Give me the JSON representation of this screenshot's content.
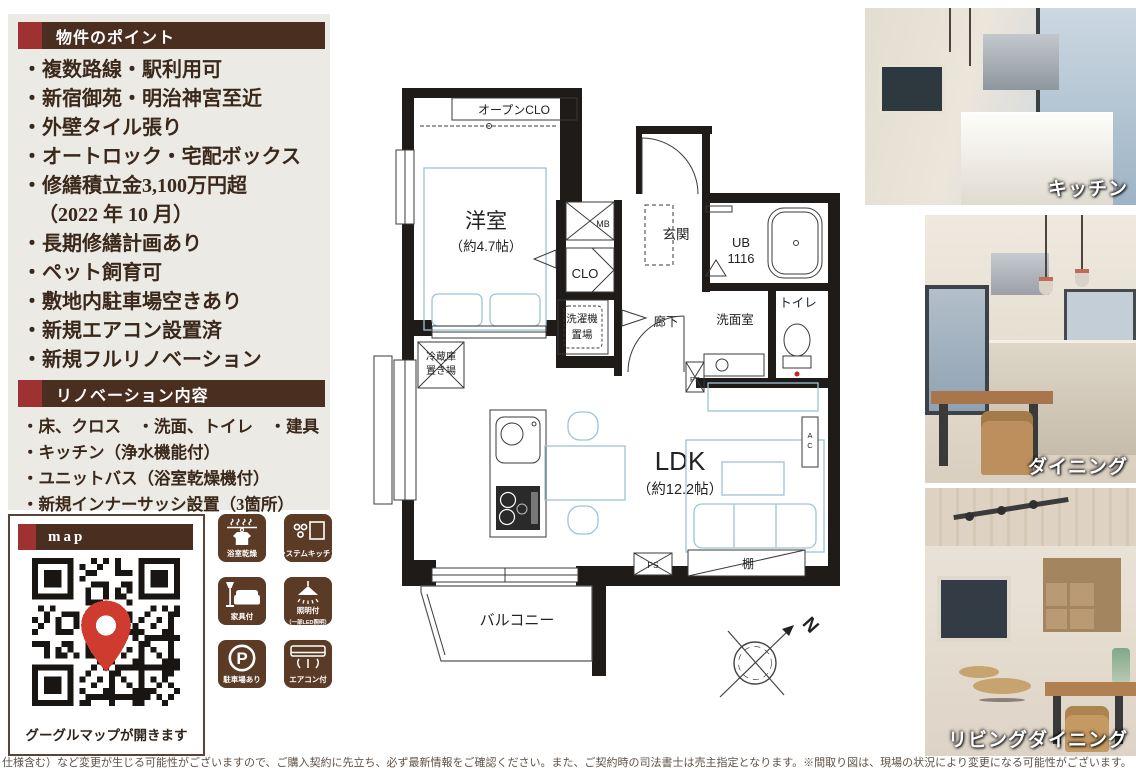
{
  "colors": {
    "accent_red": "#9e3132",
    "header_brown": "#4a2e20",
    "tile_brown": "#5b3a26",
    "text_brown": "#3a281a",
    "panel_bg": "#ECEAE5",
    "plan_furniture_blue": "#9fc4d8"
  },
  "points": {
    "header": "物件のポイント",
    "items": [
      "・複数路線・駅利用可",
      "・新宿御苑・明治神宮至近",
      "・外壁タイル張り",
      "・オートロック・宅配ボックス",
      "・修繕積立金3,100万円超",
      "（2022 年 10 月）",
      "・長期修繕計画あり",
      "・ペット飼育可",
      "・敷地内駐車場空きあり",
      "・新規エアコン設置済",
      "・新規フルリノベーション"
    ]
  },
  "renovation": {
    "header": "リノベーション内容",
    "items": [
      "・床、クロス　・洗面、トイレ　・建具",
      "・キッチン（浄水機能付）",
      "・ユニットバス（浴室乾燥機付）",
      "・新規インナーサッシ設置（3箇所）"
    ]
  },
  "map": {
    "header": "map",
    "caption": "グーグルマップが開きます"
  },
  "features": [
    {
      "icon": "bathroom-dryer-icon",
      "label": "浴室乾燥"
    },
    {
      "icon": "system-kitchen-icon",
      "label": "システムキッチン"
    },
    {
      "icon": "furniture-icon",
      "label": "家具付"
    },
    {
      "icon": "lighting-icon",
      "label": "照明付",
      "sub": "（一部LED照明）"
    },
    {
      "icon": "parking-icon",
      "label": "駐車場あり",
      "glyph": "P"
    },
    {
      "icon": "aircon-icon",
      "label": "エアコン付"
    }
  ],
  "floorplan": {
    "open_closet": "オープンCLO",
    "bedroom": "洋室",
    "bedroom_size": "（約4.7帖）",
    "mb": "MB",
    "clo": "CLO",
    "entrance": "玄関",
    "ub": "UB",
    "ub_size": "1116",
    "hallway": "廊下",
    "washer_line1": "洗濯機",
    "washer_line2": "置場",
    "washroom": "洗面室",
    "toilet": "トイレ",
    "fridge_line1": "冷蔵庫",
    "fridge_line2": "置き場",
    "ldk": "LDK",
    "ldk_size": "（約12.2帖）",
    "shelf": "棚",
    "ac_line1": "A",
    "ac_line2": "C",
    "ps": "PS",
    "balcony": "バルコニー",
    "north": "N"
  },
  "photos": [
    {
      "caption": "キッチン"
    },
    {
      "caption": "ダイニング"
    },
    {
      "caption": "リビングダイニング"
    }
  ],
  "disclaimer": "仕様含む）など変更が生じる可能性がございますので、ご購入契約に先立ち、必ず最新情報をご確認ください。また、ご契約時の司法書士は売主指定となります。※間取り図は、現場の状況により変更になる可能性がございます。"
}
